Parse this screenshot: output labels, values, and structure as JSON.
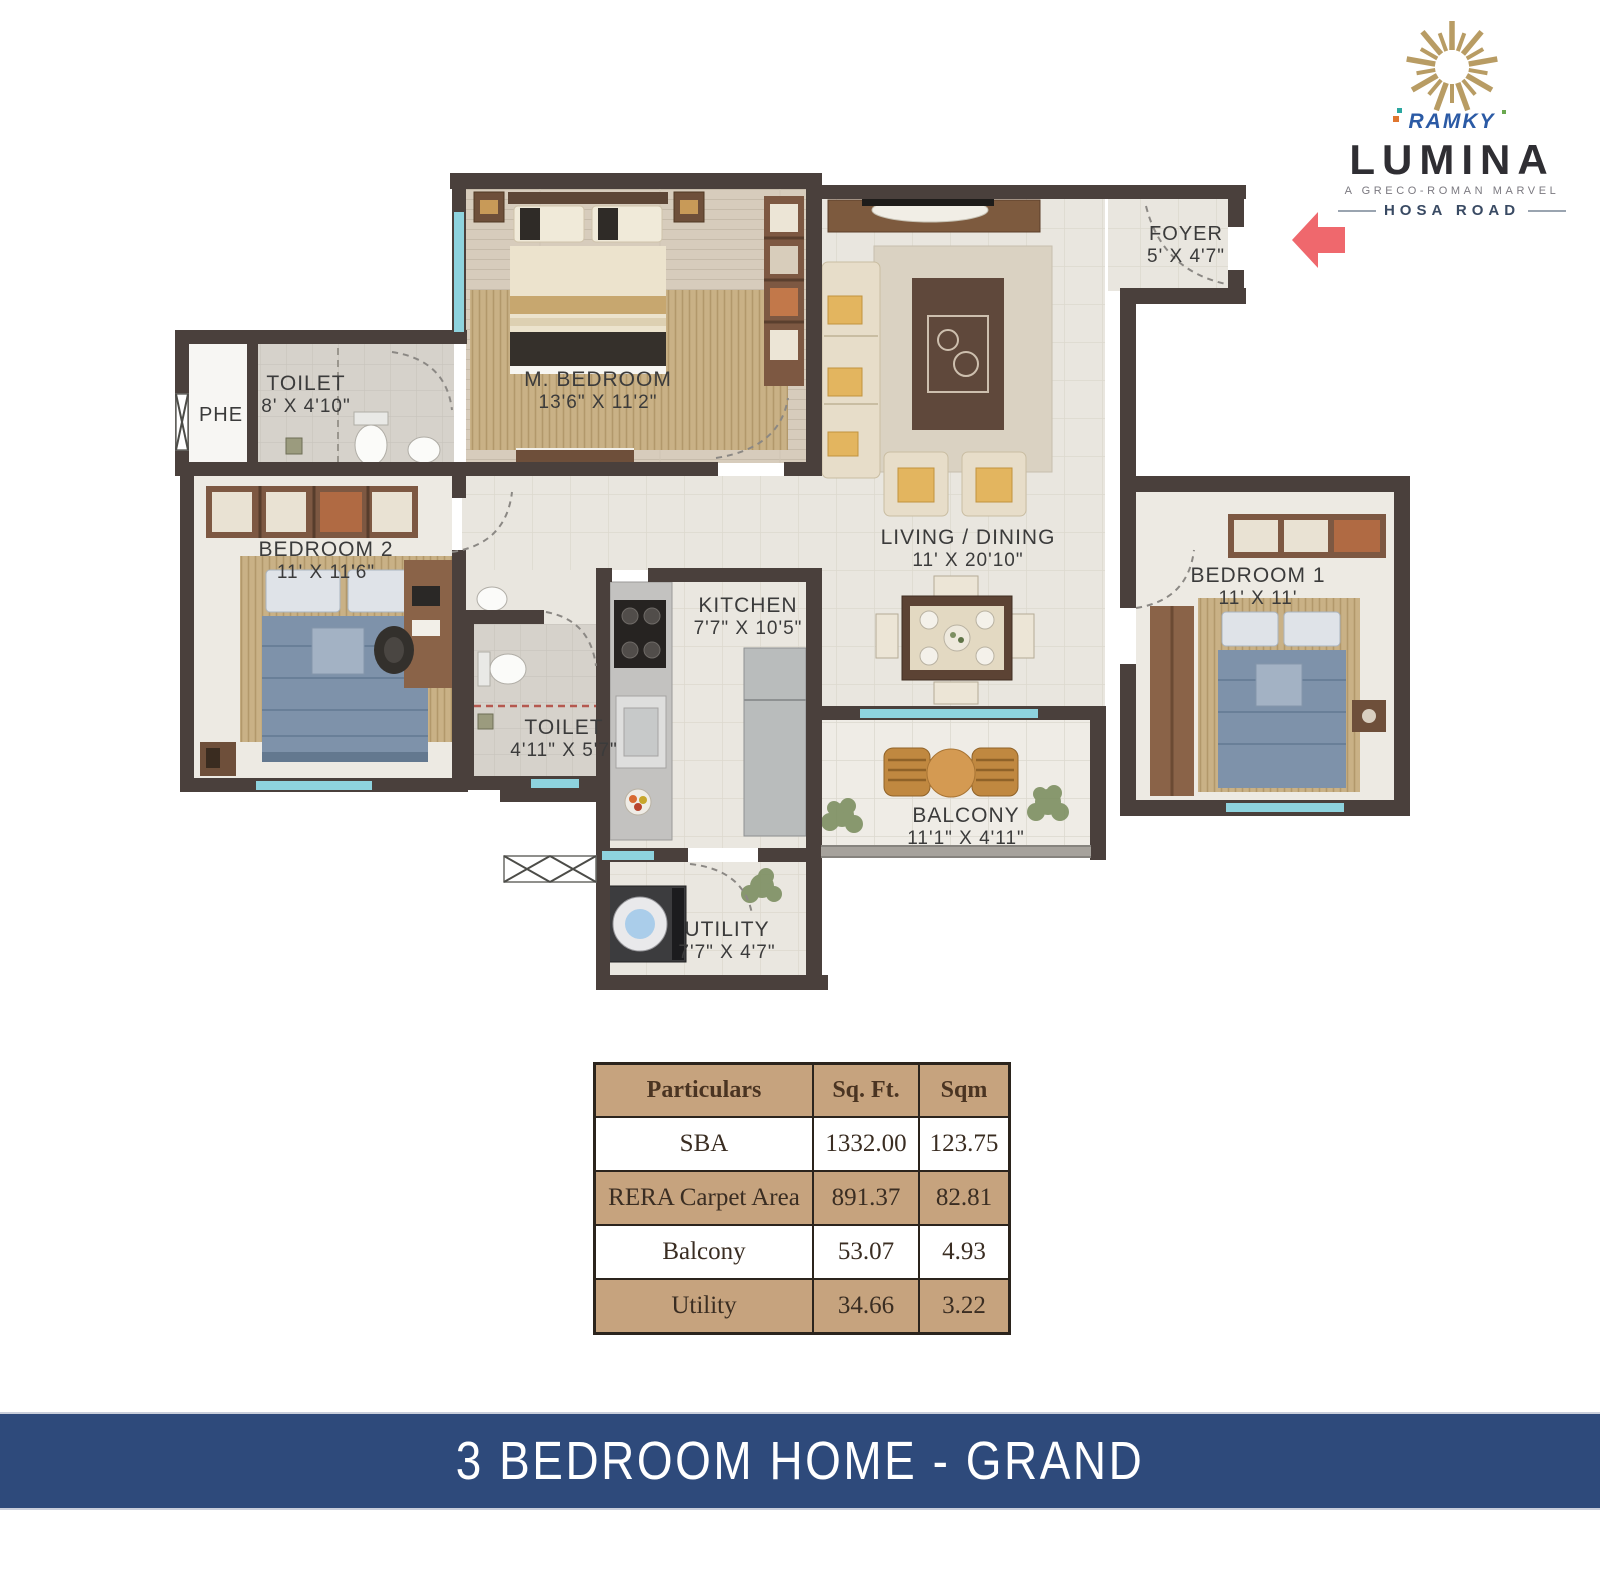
{
  "logo": {
    "brand": "RAMKY",
    "name": "LUMINA",
    "tagline": "A GRECO-ROMAN MARVEL",
    "location": "HOSA ROAD",
    "colors": {
      "sun_gold": "#b89c64",
      "brand_blue": "#2b5aa5",
      "name_dark": "#2f2e33"
    }
  },
  "floor_plan": {
    "rooms": [
      {
        "id": "foyer",
        "label": "FOYER",
        "dims": "5' X 4'7\""
      },
      {
        "id": "m_bedroom",
        "label": "M. BEDROOM",
        "dims": "13'6\" X 11'2\""
      },
      {
        "id": "toilet_1",
        "label": "TOILET",
        "dims": "8' X 4'10\""
      },
      {
        "id": "phe",
        "label": "PHE",
        "dims": ""
      },
      {
        "id": "bedroom_2",
        "label": "BEDROOM 2",
        "dims": "11' X 11'6\""
      },
      {
        "id": "living_dining",
        "label": "LIVING / DINING",
        "dims": "11' X 20'10\""
      },
      {
        "id": "bedroom_1",
        "label": "BEDROOM 1",
        "dims": "11' X 11'"
      },
      {
        "id": "kitchen",
        "label": "KITCHEN",
        "dims": "7'7\" X 10'5\""
      },
      {
        "id": "toilet_2",
        "label": "TOILET",
        "dims": "4'11\" X 5'7\""
      },
      {
        "id": "balcony",
        "label": "BALCONY",
        "dims": "11'1\" X 4'11\""
      },
      {
        "id": "utility",
        "label": "UTILITY",
        "dims": "7'7\" X 4'7\""
      }
    ],
    "entry_arrow_color": "#ef686d",
    "wall_color": "#4a403c",
    "window_color": "#8ed3de"
  },
  "area_table": {
    "headers": [
      "Particulars",
      "Sq. Ft.",
      "Sqm"
    ],
    "rows": [
      {
        "particulars": "SBA",
        "sqft": "1332.00",
        "sqm": "123.75"
      },
      {
        "particulars": "RERA Carpet Area",
        "sqft": "891.37",
        "sqm": "82.81"
      },
      {
        "particulars": "Balcony",
        "sqft": "53.07",
        "sqm": "4.93"
      },
      {
        "particulars": "Utility",
        "sqft": "34.66",
        "sqm": "3.22"
      }
    ]
  },
  "footer": {
    "title": "3 BEDROOM HOME - GRAND",
    "bg": "#2e4a7b"
  }
}
